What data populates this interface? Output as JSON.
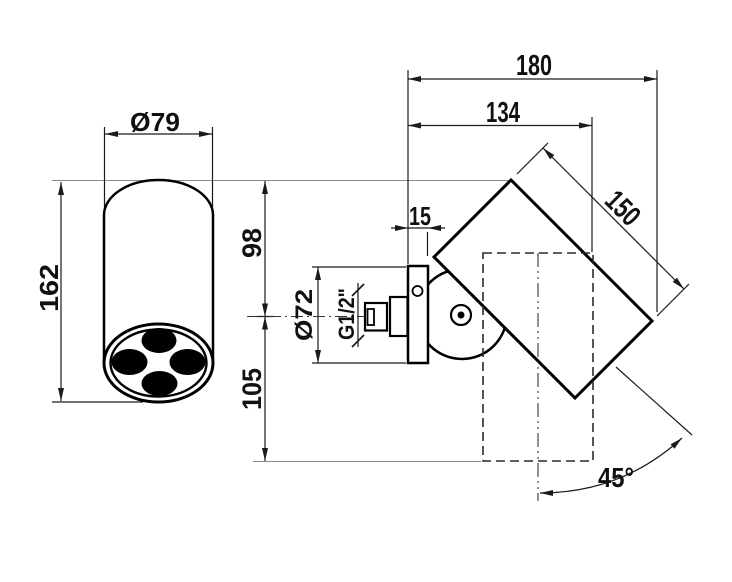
{
  "drawing": {
    "type": "technical-dimension-drawing",
    "subject": "wall-mounted adjustable shower head, side and front views",
    "line_color": "#1a1a1a",
    "reference_line_color": "#8a8a8a",
    "background_color": "#ffffff",
    "dims": {
      "overall_depth": "180",
      "body_depth": "134",
      "head_length": "150",
      "plate_thickness": "15",
      "above_axis": "98",
      "below_axis": "105",
      "plate_diameter": "Ø72",
      "head_diameter": "Ø79",
      "head_height": "162",
      "thread": "G1/2\"",
      "swivel_angle": "45°"
    }
  }
}
